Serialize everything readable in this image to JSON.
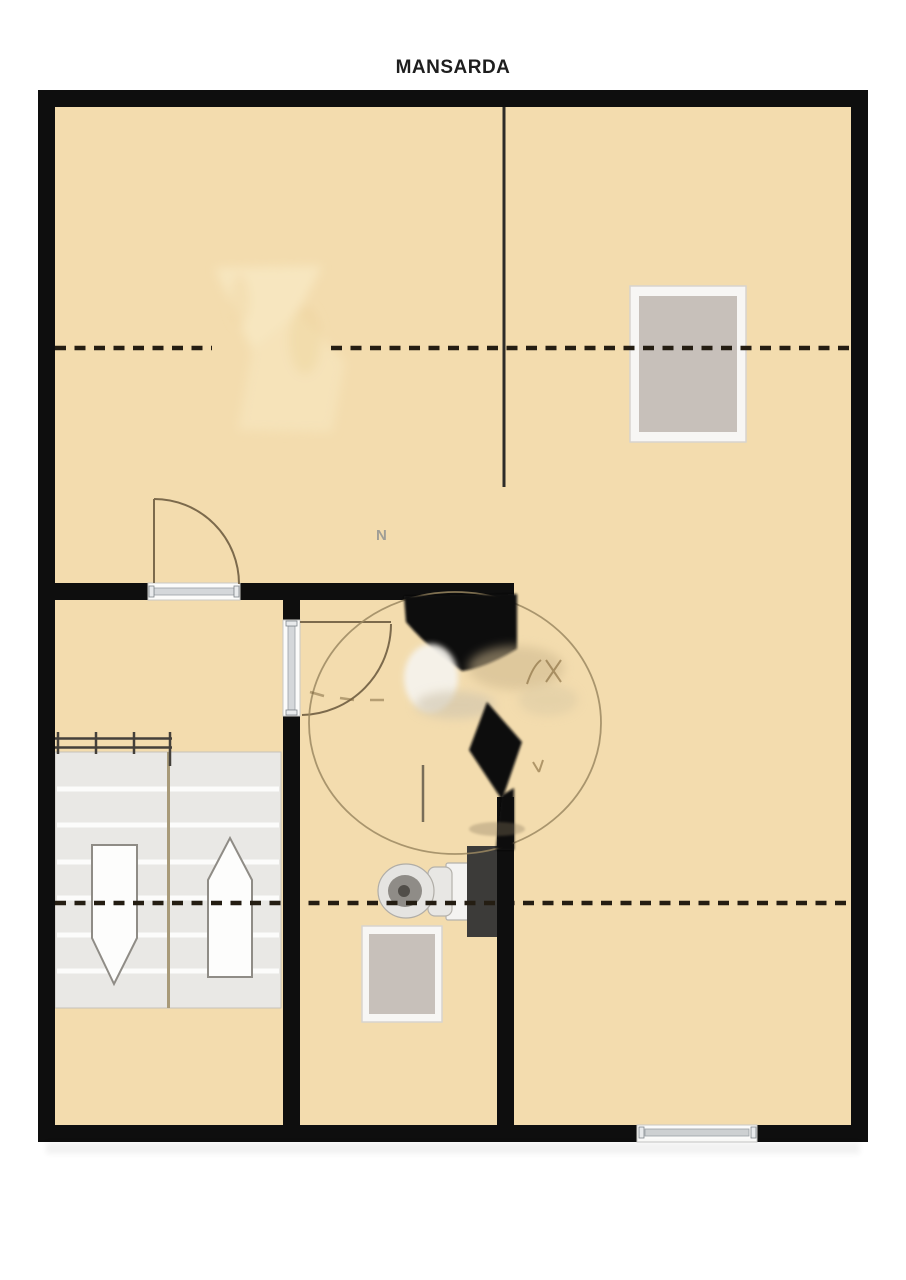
{
  "title": "MANSARDA",
  "plan": {
    "watermark_letter": "N",
    "features": [
      "outer-walls",
      "attic-dashed-headroom-lines",
      "skylight-window-right",
      "skylight-window-bathroom",
      "staircase-double-flight",
      "stair-arrow-down",
      "stair-arrow-up",
      "stair-railing",
      "door-swing-upper",
      "door-swing-bathroom",
      "toilet",
      "dark-fixture",
      "bottom-window",
      "smudged-watermark-circle",
      "smudged-area-upper-left"
    ]
  },
  "colors": {
    "background": "#ffffff",
    "floor": "#f3dcae",
    "wall": "#0e0e0e",
    "dashed_line": "#241d12",
    "stair_tread": "#e9e8e5",
    "skylight": "#c7c0ba",
    "skylight_frame": "#f7f6f4",
    "door_arc": "#7c6a4c",
    "fixture_dark": "#3c3b39",
    "toilet_body": "#e5e4e1",
    "watermark_stroke": "#9b8862",
    "arrow_fill": "#fdfdfc",
    "title_color": "#1e1e1e"
  }
}
